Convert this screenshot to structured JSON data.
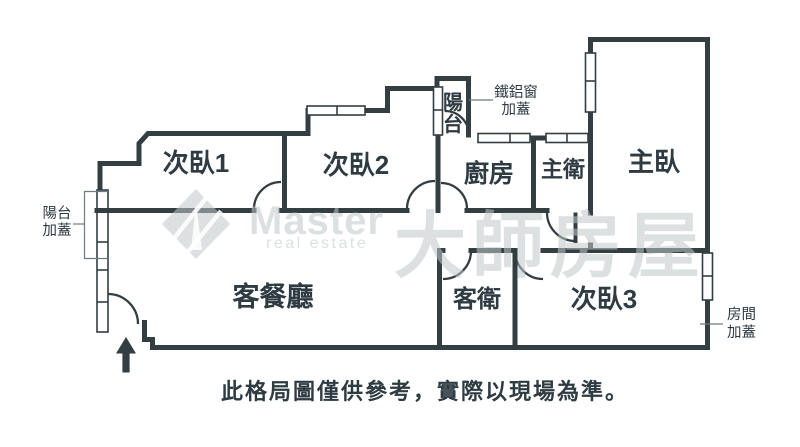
{
  "floorplan": {
    "rooms": [
      {
        "key": "bedroom1",
        "label": "次臥1"
      },
      {
        "key": "bedroom2",
        "label": "次臥2"
      },
      {
        "key": "kitchen",
        "label": "廚房"
      },
      {
        "key": "master_bath",
        "label": "主衛"
      },
      {
        "key": "master_bedroom",
        "label": "主臥"
      },
      {
        "key": "living_dining",
        "label": "客餐廳"
      },
      {
        "key": "guest_bath",
        "label": "客衛"
      },
      {
        "key": "bedroom3",
        "label": "次臥3"
      }
    ],
    "small_balcony": {
      "char1": "陽",
      "char2": "台"
    },
    "annotations": {
      "left_balcony_line1": "陽台",
      "left_balcony_line2": "加蓋",
      "window_cover_line1": "鐵鋁窗",
      "window_cover_line2": "加蓋",
      "room_cover_line1": "房間",
      "room_cover_line2": "加蓋"
    },
    "disclaimer": "此格局圖僅供參考，實際以現場為準。"
  },
  "watermark": {
    "brand": "Master",
    "tagline": "real estate",
    "cjk": "大師房屋"
  },
  "colors": {
    "wall": "#333e43",
    "label_text": "#2e3b42",
    "watermark": "#bfc6c8",
    "annotation_line": "#6d7b80",
    "background": "#ffffff"
  }
}
